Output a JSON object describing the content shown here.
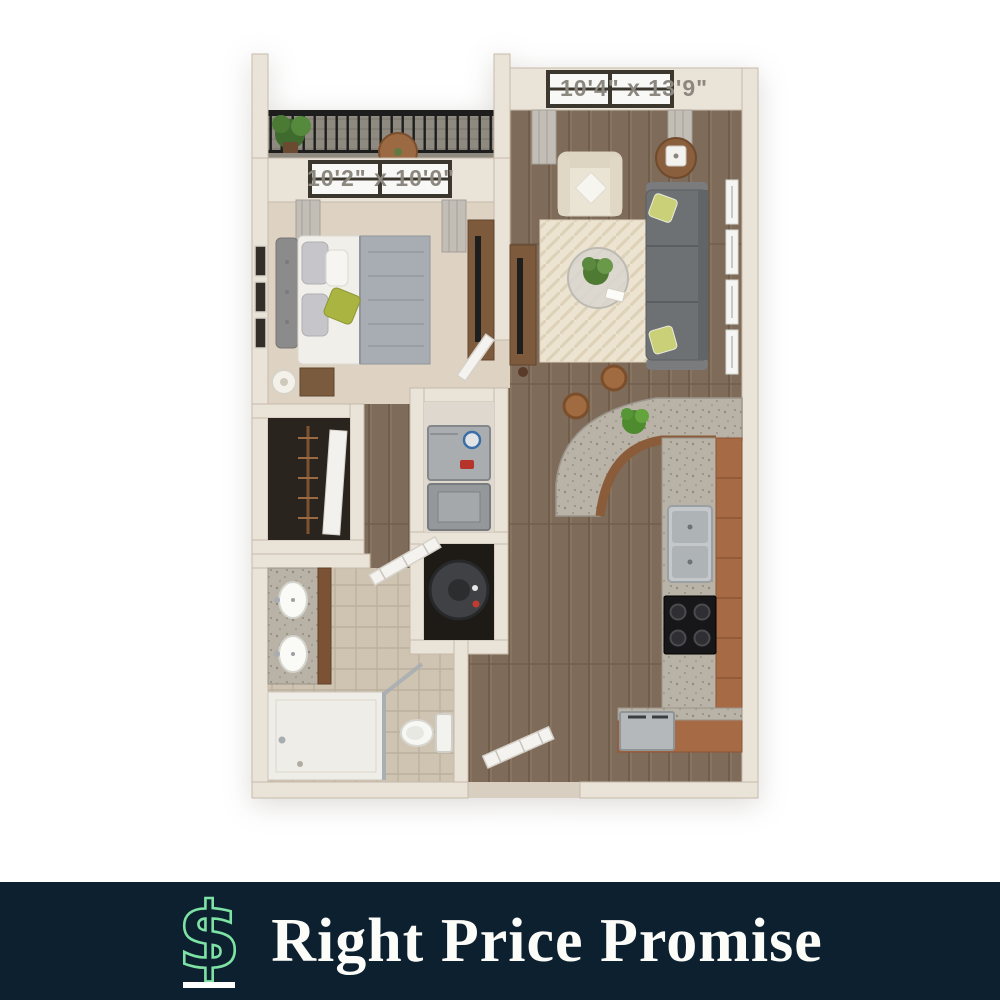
{
  "floor_plan": {
    "living_room_dimensions": "10'4\" x 13'9\"",
    "bedroom_dimensions": "10'2\" x 10'0\""
  },
  "banner": {
    "title": "Right Price Promise",
    "icon": "dollar-sign-icon"
  },
  "colors": {
    "banner_bg": "#0c2030",
    "accent_green": "#7de2a3",
    "banner_text": "#fcfcf9",
    "label_text": "#8c8880",
    "wall": "#eae3d8",
    "wood_floor": "#7e6b59",
    "bedroom_carpet": "#ded3c3",
    "bath_tile": "#cfc3b2",
    "granite": "#b8b2a7",
    "cabinet_wood": "#a66a44",
    "sofa_gray": "#6e7173",
    "rug_cream": "#ece3d1",
    "accent_pillow_green": "#a9b441"
  }
}
